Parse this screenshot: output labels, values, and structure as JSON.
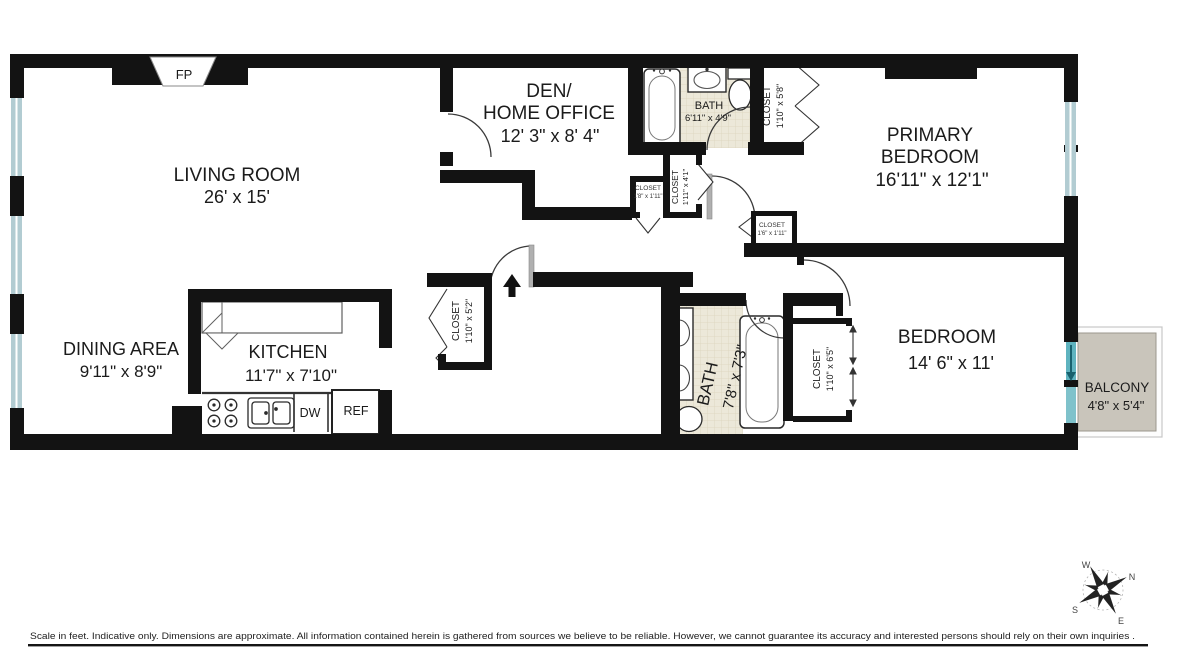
{
  "plan": {
    "rooms": {
      "living_room": {
        "name": "LIVING ROOM",
        "dims": "26' x 15'"
      },
      "dining_area": {
        "name": "DINING AREA",
        "dims": "9'11\" x 8'9\""
      },
      "kitchen": {
        "name": "KITCHEN",
        "dims": "11'7\" x 7'10\""
      },
      "den": {
        "name1": "DEN/",
        "name2": "HOME OFFICE",
        "dims": "12' 3\" x 8' 4\""
      },
      "bath1": {
        "name": "BATH",
        "dims": "6'11\" x 4'9\""
      },
      "bath2": {
        "name": "BATH",
        "dims": "7'8\" x 7'3\""
      },
      "primary_bedroom": {
        "name1": "PRIMARY",
        "name2": "BEDROOM",
        "dims": "16'11\" x 12'1\""
      },
      "bedroom": {
        "name": "BEDROOM",
        "dims": "14' 6\" x 11'"
      },
      "balcony": {
        "name": "BALCONY",
        "dims": "4'8\" x 5'4\""
      }
    },
    "closets": {
      "hall_58": {
        "name": "CLOSET",
        "dims": "1'10\" x 5'8\""
      },
      "hall_41": {
        "name": "CLOSET",
        "dims": "1'11\" x 4'1\""
      },
      "hall_18": {
        "name": "CLOSET",
        "dims": "1'8\" x 1'11\""
      },
      "hall_16": {
        "name": "CLOSET",
        "dims": "1'6\" x 1'11\""
      },
      "foyer_52": {
        "name": "CLOSET",
        "dims": "1'10\" x 5'2\""
      },
      "bedroom_65": {
        "name": "CLOSET",
        "dims": "1'10\" x 6'5\""
      }
    },
    "fixtures": {
      "fireplace": "FP",
      "dishwasher": "DW",
      "refrigerator": "REF"
    },
    "compass": {
      "n": "N",
      "w": "W",
      "s": "S",
      "e": "E"
    },
    "footer": {
      "disclaimer": "Scale in feet. Indicative only. Dimensions are approximate. All information contained herein is gathered from sources we believe to be reliable. However, we cannot guarantee its accuracy and interested persons should rely on their own  inquiries ."
    },
    "colors": {
      "wall": "#131313",
      "window": "#b2ccd2",
      "balcony_glass": "#5fb3bf",
      "bath_tile": "#ece8d9",
      "balcony_floor": "#c9c5bb"
    }
  }
}
